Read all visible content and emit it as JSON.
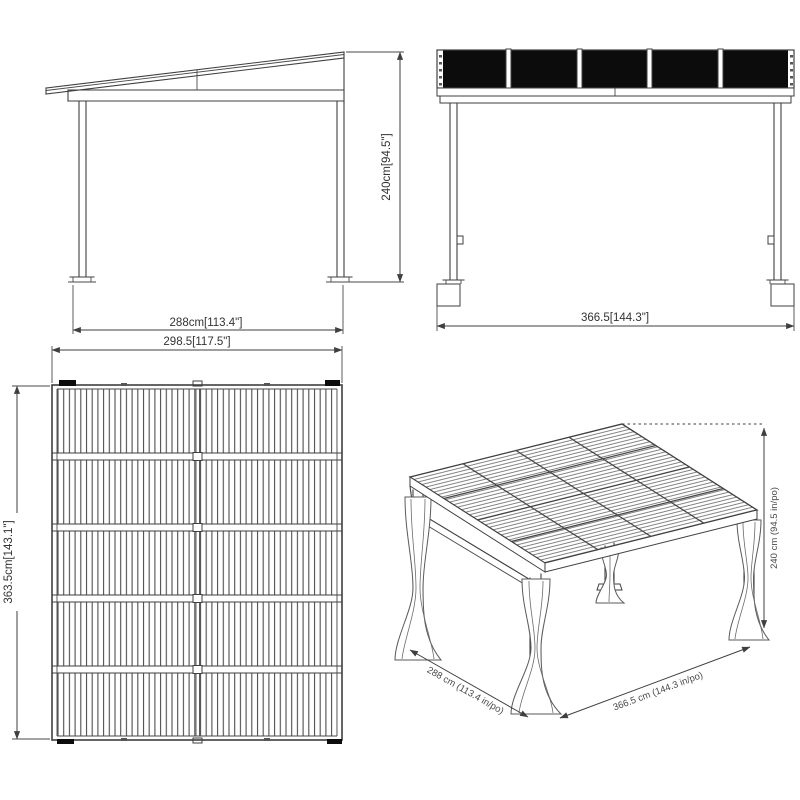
{
  "drawing": {
    "colors": {
      "background": "#ffffff",
      "line": "#3f3f3f",
      "text": "#333333",
      "roof_panel_fill": "#0c0c0c"
    },
    "views": {
      "side": {
        "title": "side-elevation",
        "width_label": "288cm[113.4\"]",
        "height_label": "240cm[94.5\"]"
      },
      "front": {
        "title": "front-elevation",
        "width_label": "366.5[144.3\"]"
      },
      "plan": {
        "title": "roof-plan",
        "width_label": "298.5[117.5\"]",
        "height_label": "363.5cm[143.1\"]"
      },
      "iso": {
        "title": "isometric-view",
        "depth_label": "288 cm (113.4 in/po)",
        "width_label": "366.5 cm (144.3 in/po)",
        "height_label": "240 cm (94.5 in/po)"
      }
    }
  }
}
